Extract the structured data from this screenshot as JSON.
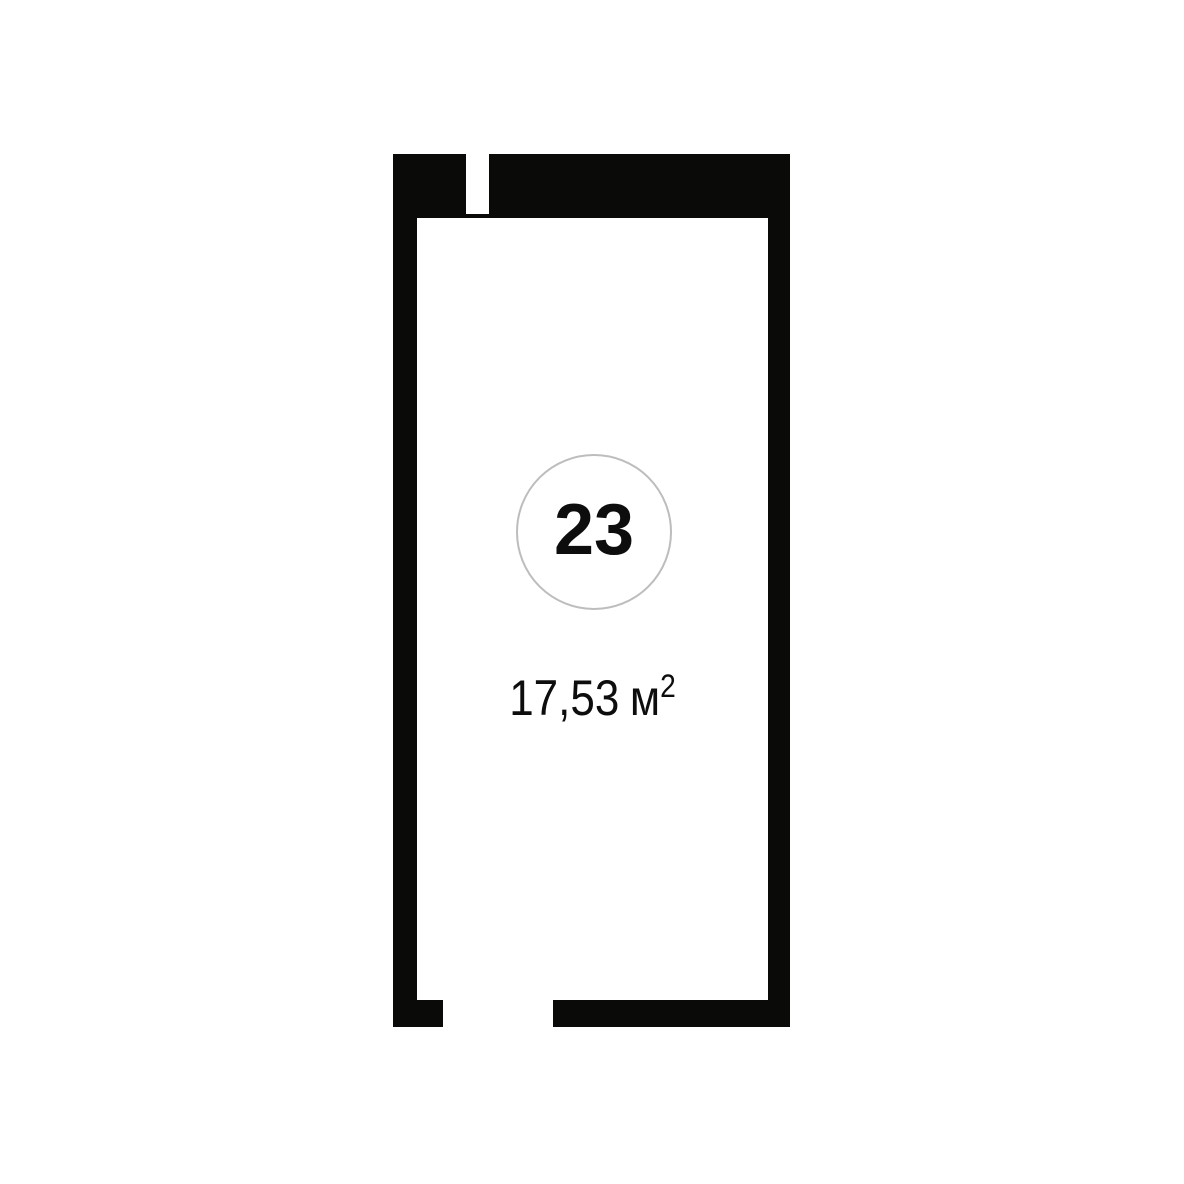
{
  "plan": {
    "room": {
      "number": "23",
      "area_value": "17,53",
      "area_unit": "м",
      "area_exponent": "2"
    },
    "colors": {
      "wall": "#0a0a08",
      "background": "#ffffff",
      "circle_border": "#bdbdbd",
      "text": "#0d0d0d"
    }
  }
}
